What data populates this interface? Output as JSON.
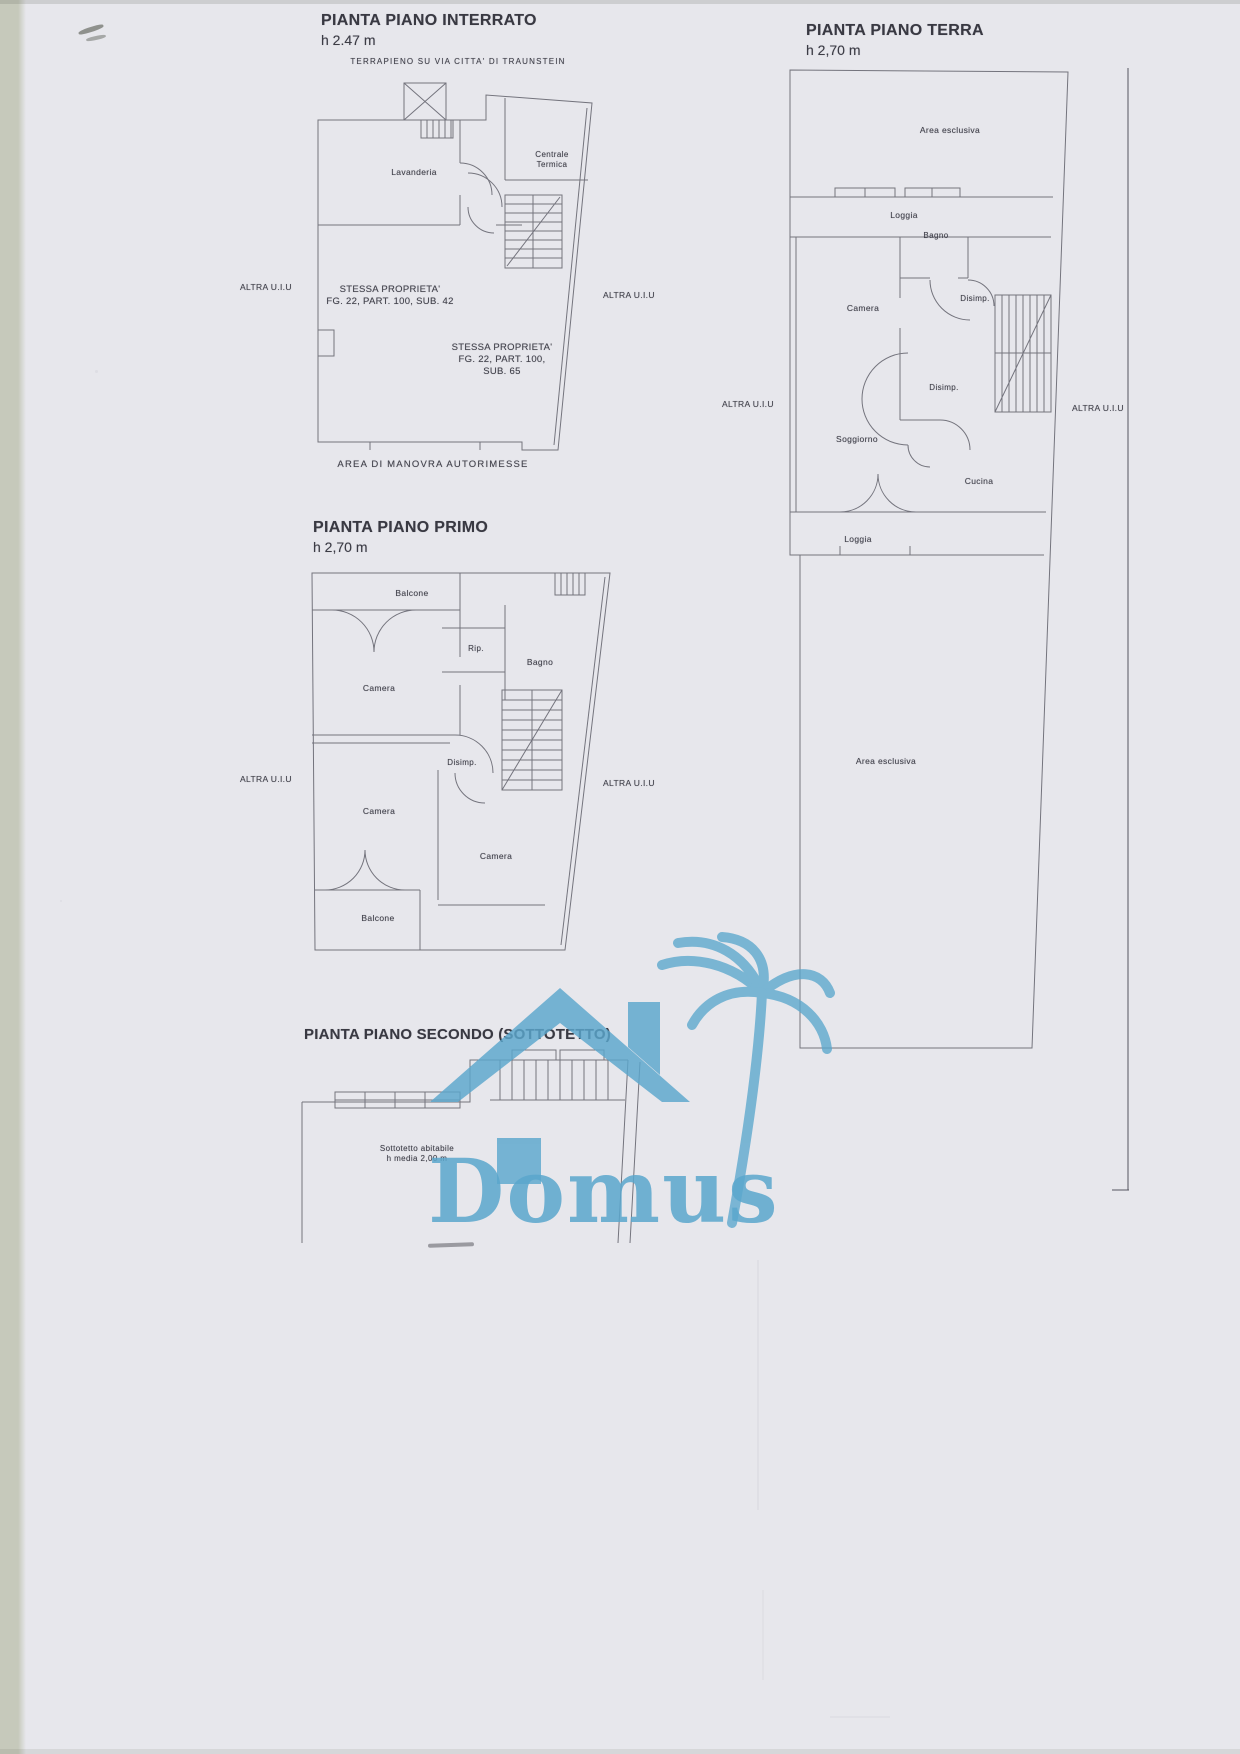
{
  "colors": {
    "paper": "#e7e7ec",
    "strip": "#c6c9bb",
    "line": "#60606a",
    "ink": "#42424b",
    "logo": "#5ba7cd"
  },
  "interrato": {
    "title": "PIANTA PIANO INTERRATO",
    "height_note": "h 2.47 m",
    "terrapieno": "TERRAPIENO SU VIA CITTA' DI TRAUNSTEIN",
    "lavanderia": "Lavanderia",
    "centrale_termica": "Centrale\nTermica",
    "stessa_a": "STESSA PROPRIETA'\nFG. 22, PART. 100, SUB. 42",
    "stessa_b": "STESSA PROPRIETA'\nFG. 22, PART. 100,\nSUB. 65",
    "altra_left": "ALTRA U.I.U",
    "altra_right": "ALTRA U.I.U",
    "area_manovra": "AREA DI MANOVRA AUTORIMESSE"
  },
  "terra": {
    "title": "PIANTA PIANO TERRA",
    "height_note": "h 2,70 m",
    "area_esclusiva_top": "Area esclusiva",
    "loggia_top": "Loggia",
    "bagno": "Bagno",
    "camera": "Camera",
    "disimp_1": "Disimp.",
    "disimp_2": "Disimp.",
    "soggiorno": "Soggiorno",
    "cucina": "Cucina",
    "loggia_bottom": "Loggia",
    "altra_left": "ALTRA U.I.U",
    "altra_right": "ALTRA U.I.U",
    "area_esclusiva_bottom": "Area esclusiva"
  },
  "primo": {
    "title": "PIANTA PIANO PRIMO",
    "height_note": "h 2,70 m",
    "balcone_top": "Balcone",
    "rip": "Rip.",
    "bagno": "Bagno",
    "camera_1": "Camera",
    "disimp": "Disimp.",
    "camera_2": "Camera",
    "camera_3": "Camera",
    "balcone_bottom": "Balcone",
    "altra_left": "ALTRA U.I.U",
    "altra_right": "ALTRA U.I.U"
  },
  "secondo": {
    "title": "PIANTA PIANO SECONDO (SOTTOTETTO)",
    "sottotetto_note": "Sottotetto abitabile\nh media 2,00 m"
  },
  "logo": {
    "wordmark": "Domus"
  }
}
